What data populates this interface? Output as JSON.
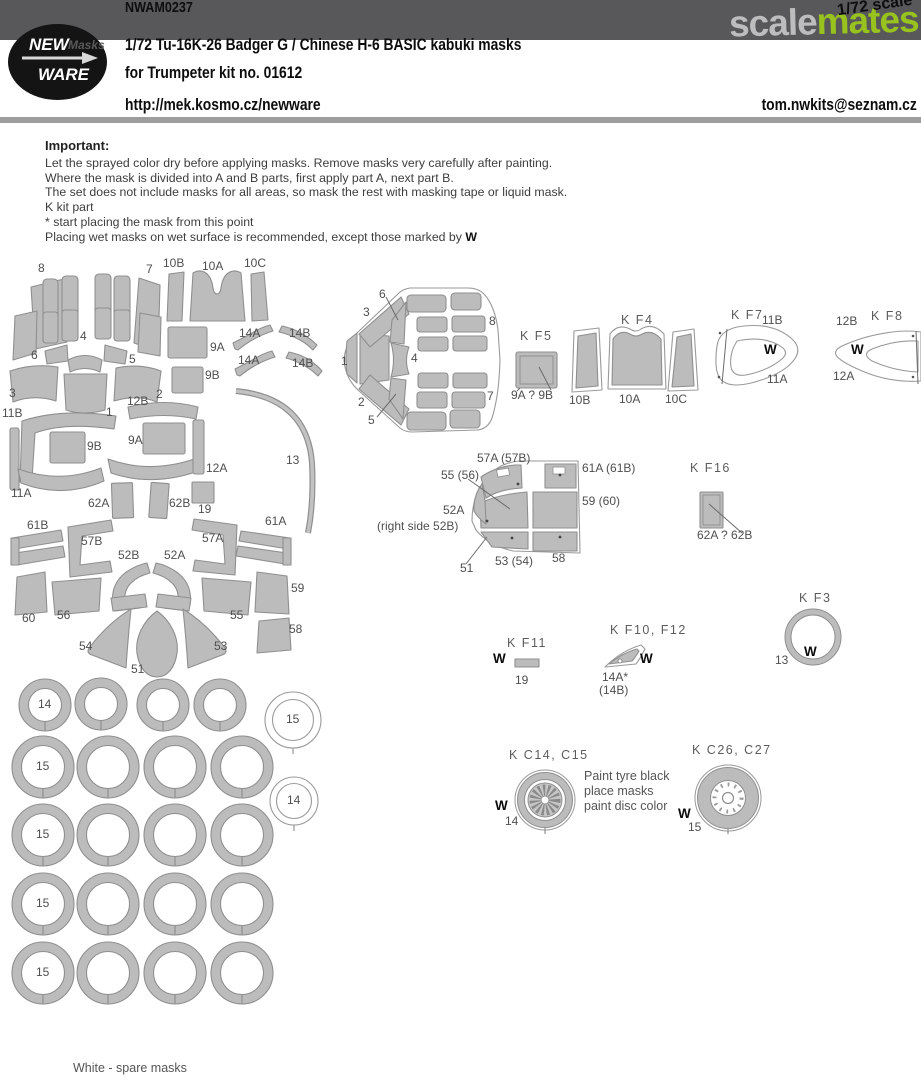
{
  "header": {
    "product_code": "NWAM0237",
    "scale_note": "1/72 scale",
    "watermark_scale": "scale",
    "watermark_mates": "mates",
    "logo_new": "NEW",
    "logo_masks": "Masks",
    "logo_ware": "WARE",
    "title": "1/72 Tu-16K-26 Badger G / Chinese H-6 BASIC kabuki masks",
    "subtitle": "for Trumpeter kit no. 01612",
    "website": "http://mek.kosmo.cz/newware",
    "email": "tom.nwkits@seznam.cz"
  },
  "important": {
    "heading": "Important:",
    "lines": [
      "Let the sprayed color dry before applying masks. Remove masks very carefully after painting.",
      "Where the mask is divided into A and B parts, first apply part A, next part B.",
      "The set does not include masks for all areas, so mask the rest with masking tape or liquid mask.",
      "K kit part",
      "*  start placing the mask from this point"
    ],
    "last_line": "Placing wet masks on wet surface is recommended, except those marked by ",
    "w_mark": "W"
  },
  "colors": {
    "banner": "#58585a",
    "mates_green": "#98c21e",
    "mask_fill": "#bcbcbc",
    "mask_outline": "#8f8f8f"
  },
  "diagram": {
    "footnote": "White - spare masks",
    "labels": [
      {
        "text": "8",
        "x": 38,
        "y": 262
      },
      {
        "text": "7",
        "x": 146,
        "y": 263
      },
      {
        "text": "10B",
        "x": 163,
        "y": 257
      },
      {
        "text": "10A",
        "x": 202,
        "y": 260
      },
      {
        "text": "10C",
        "x": 244,
        "y": 257
      },
      {
        "text": "9A",
        "x": 210,
        "y": 341
      },
      {
        "text": "9B",
        "x": 205,
        "y": 369
      },
      {
        "text": "14A",
        "x": 239,
        "y": 327
      },
      {
        "text": "14B",
        "x": 289,
        "y": 327
      },
      {
        "text": "14A",
        "x": 238,
        "y": 354
      },
      {
        "text": "14B",
        "x": 292,
        "y": 357
      },
      {
        "text": "4",
        "x": 80,
        "y": 330
      },
      {
        "text": "6",
        "x": 31,
        "y": 349
      },
      {
        "text": "5",
        "x": 129,
        "y": 353
      },
      {
        "text": "3",
        "x": 9,
        "y": 387
      },
      {
        "text": "12B",
        "x": 127,
        "y": 395
      },
      {
        "text": "2",
        "x": 156,
        "y": 388
      },
      {
        "text": "1",
        "x": 106,
        "y": 406
      },
      {
        "text": "11B",
        "x": 2,
        "y": 407
      },
      {
        "text": "9B",
        "x": 87,
        "y": 440
      },
      {
        "text": "9A",
        "x": 128,
        "y": 434
      },
      {
        "text": "12A",
        "x": 206,
        "y": 462
      },
      {
        "text": "13",
        "x": 286,
        "y": 454
      },
      {
        "text": "11A",
        "x": 11,
        "y": 487
      },
      {
        "text": "62A",
        "x": 88,
        "y": 497
      },
      {
        "text": "62B",
        "x": 169,
        "y": 497
      },
      {
        "text": "19",
        "x": 198,
        "y": 503
      },
      {
        "text": "61B",
        "x": 27,
        "y": 519
      },
      {
        "text": "57B",
        "x": 81,
        "y": 535
      },
      {
        "text": "57A",
        "x": 202,
        "y": 532
      },
      {
        "text": "61A",
        "x": 265,
        "y": 515
      },
      {
        "text": "52B",
        "x": 118,
        "y": 549
      },
      {
        "text": "52A",
        "x": 164,
        "y": 549
      },
      {
        "text": "59",
        "x": 291,
        "y": 582
      },
      {
        "text": "60",
        "x": 22,
        "y": 612
      },
      {
        "text": "56",
        "x": 57,
        "y": 609
      },
      {
        "text": "55",
        "x": 230,
        "y": 609
      },
      {
        "text": "58",
        "x": 289,
        "y": 623
      },
      {
        "text": "54",
        "x": 79,
        "y": 640
      },
      {
        "text": "53",
        "x": 214,
        "y": 640
      },
      {
        "text": "51",
        "x": 131,
        "y": 663
      },
      {
        "text": "14",
        "x": 38,
        "y": 698
      },
      {
        "text": "15",
        "x": 286,
        "y": 713
      },
      {
        "text": "15",
        "x": 36,
        "y": 760
      },
      {
        "text": "14",
        "x": 287,
        "y": 794
      },
      {
        "text": "15",
        "x": 36,
        "y": 828
      },
      {
        "text": "15",
        "x": 36,
        "y": 897
      },
      {
        "text": "15",
        "x": 36,
        "y": 966
      },
      {
        "text": "6",
        "x": 379,
        "y": 288
      },
      {
        "text": "3",
        "x": 363,
        "y": 306
      },
      {
        "text": "8",
        "x": 489,
        "y": 315
      },
      {
        "text": "1",
        "x": 341,
        "y": 355
      },
      {
        "text": "4",
        "x": 411,
        "y": 352
      },
      {
        "text": "2",
        "x": 358,
        "y": 396
      },
      {
        "text": "5",
        "x": 368,
        "y": 414
      },
      {
        "text": "7",
        "x": 487,
        "y": 390
      },
      {
        "text": "K F5",
        "x": 520,
        "y": 330,
        "cls": "group"
      },
      {
        "text": "9A ? 9B",
        "x": 511,
        "y": 389
      },
      {
        "text": "K F4",
        "x": 621,
        "y": 314,
        "cls": "group"
      },
      {
        "text": "10B",
        "x": 569,
        "y": 394
      },
      {
        "text": "10A",
        "x": 619,
        "y": 393
      },
      {
        "text": "10C",
        "x": 665,
        "y": 393
      },
      {
        "text": "K F7",
        "x": 731,
        "y": 309,
        "cls": "group"
      },
      {
        "text": "11B",
        "x": 762,
        "y": 314
      },
      {
        "text": "W",
        "x": 764,
        "y": 343,
        "cls": "w"
      },
      {
        "text": "11A",
        "x": 767,
        "y": 373
      },
      {
        "text": "12B",
        "x": 836,
        "y": 315
      },
      {
        "text": "K F8",
        "x": 871,
        "y": 310,
        "cls": "group"
      },
      {
        "text": "W",
        "x": 851,
        "y": 343,
        "cls": "w"
      },
      {
        "text": "12A",
        "x": 833,
        "y": 370
      },
      {
        "text": "57A (57B)",
        "x": 477,
        "y": 452
      },
      {
        "text": "55 (56)",
        "x": 441,
        "y": 469
      },
      {
        "text": "61A (61B)",
        "x": 582,
        "y": 462
      },
      {
        "text": "59 (60)",
        "x": 582,
        "y": 495
      },
      {
        "text": "52A",
        "x": 443,
        "y": 504
      },
      {
        "text": "(right side 52B)",
        "x": 377,
        "y": 520
      },
      {
        "text": "51",
        "x": 460,
        "y": 562
      },
      {
        "text": "53 (54)",
        "x": 495,
        "y": 555
      },
      {
        "text": "58",
        "x": 552,
        "y": 552
      },
      {
        "text": "K F16",
        "x": 690,
        "y": 462,
        "cls": "group"
      },
      {
        "text": "62A ? 62B",
        "x": 697,
        "y": 529
      },
      {
        "text": "K F11",
        "x": 507,
        "y": 637,
        "cls": "group"
      },
      {
        "text": "W",
        "x": 493,
        "y": 652,
        "cls": "w"
      },
      {
        "text": "19",
        "x": 515,
        "y": 674
      },
      {
        "text": "K F10, F12",
        "x": 610,
        "y": 624,
        "cls": "group"
      },
      {
        "text": "W",
        "x": 640,
        "y": 652,
        "cls": "w"
      },
      {
        "text": "14A*",
        "x": 602,
        "y": 671
      },
      {
        "text": "(14B)",
        "x": 599,
        "y": 684
      },
      {
        "text": "K F3",
        "x": 799,
        "y": 592,
        "cls": "group"
      },
      {
        "text": "13",
        "x": 775,
        "y": 654
      },
      {
        "text": "W",
        "x": 804,
        "y": 645,
        "cls": "w"
      },
      {
        "text": "K C14, C15",
        "x": 509,
        "y": 749,
        "cls": "group"
      },
      {
        "text": "W",
        "x": 495,
        "y": 799,
        "cls": "w"
      },
      {
        "text": "14",
        "x": 505,
        "y": 815
      },
      {
        "text": "Paint tyre black",
        "x": 584,
        "y": 770,
        "cls": "note"
      },
      {
        "text": "place masks",
        "x": 584,
        "y": 785,
        "cls": "note"
      },
      {
        "text": "paint disc color",
        "x": 584,
        "y": 800,
        "cls": "note"
      },
      {
        "text": "K C26, C27",
        "x": 692,
        "y": 744,
        "cls": "group"
      },
      {
        "text": "W",
        "x": 678,
        "y": 807,
        "cls": "w"
      },
      {
        "text": "15",
        "x": 688,
        "y": 821
      },
      {
        "text": "White - spare masks",
        "x": 73,
        "y": 1062,
        "cls": "note"
      }
    ]
  }
}
